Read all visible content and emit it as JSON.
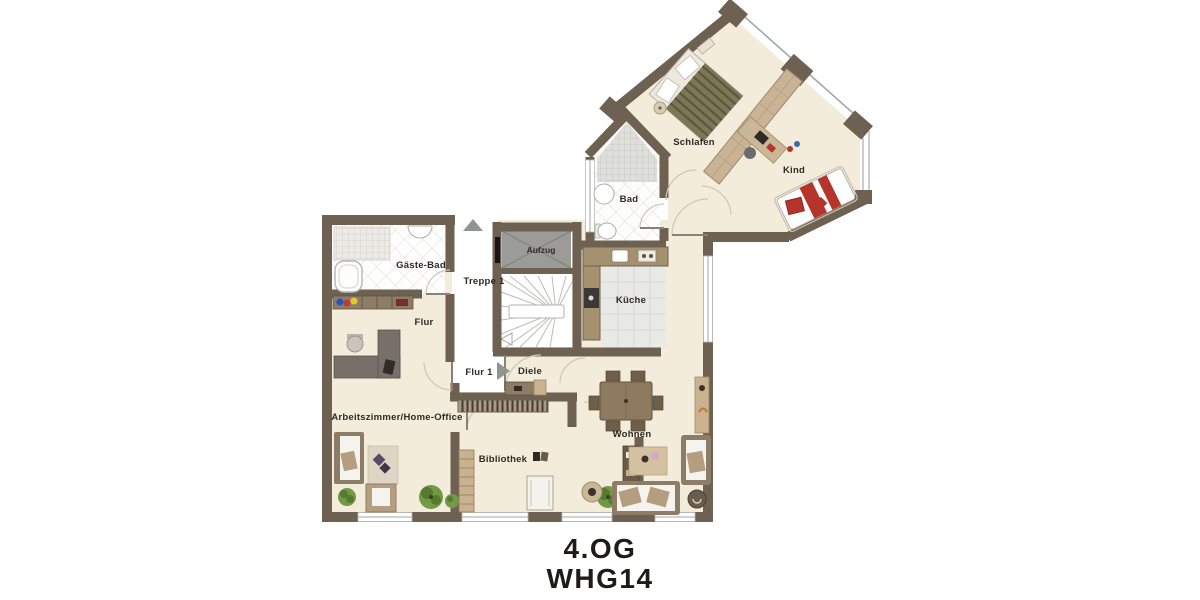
{
  "meta": {
    "floor_label": "4.OG",
    "unit_label": "WHG14"
  },
  "rooms": {
    "schlafen": "Schlafen",
    "kind": "Kind",
    "bad": "Bad",
    "aufzug": "Aufzug",
    "treppe": "Treppe 1",
    "gaeste_bad": "Gäste-Bad",
    "flur": "Flur",
    "flur1": "Flur 1",
    "diele": "Diele",
    "kueche": "Küche",
    "arbeitszimmer": "Arbeitszimmer/Home-Office",
    "wohnen": "Wohnen",
    "bibliothek": "Bibliothek"
  },
  "icons": [
    {
      "name": "up-direction-icon"
    },
    {
      "name": "right-direction-icon"
    }
  ],
  "colors": {
    "wall": "#6e6152",
    "floor": "#f3ecdb",
    "accent_red": "#b5342c",
    "elevator_gray": "#9b9b98",
    "wood_tan": "#c9b28d",
    "plant_green": "#729a45"
  }
}
